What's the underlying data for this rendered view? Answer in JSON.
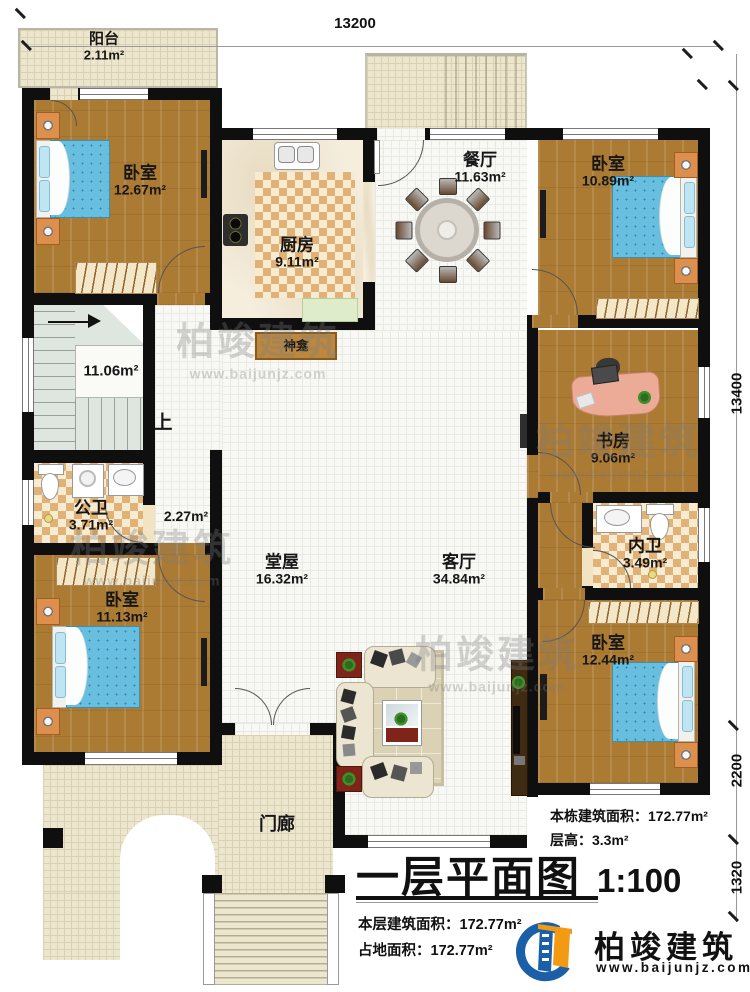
{
  "plan": {
    "title": "一层平面图",
    "scale": "1:100"
  },
  "dimensions": {
    "top": "13200",
    "right_upper": "13400",
    "right_middle": "2200",
    "right_lower": "1320"
  },
  "rooms": {
    "balcony": {
      "name": "阳台",
      "area": "2.11m²"
    },
    "bedroom_nw": {
      "name": "卧室",
      "area": "12.67m²"
    },
    "kitchen": {
      "name": "厨房",
      "area": "9.11m²"
    },
    "dining": {
      "name": "餐厅",
      "area": "11.63m²"
    },
    "bedroom_ne": {
      "name": "卧室",
      "area": "10.89m²"
    },
    "stairwell": {
      "area": "11.06m²",
      "up": "上"
    },
    "shrine": {
      "name": "神龛"
    },
    "public_bath": {
      "name": "公卫",
      "area": "3.71m²"
    },
    "corridor": {
      "area": "2.27m²"
    },
    "hall": {
      "name": "堂屋",
      "area": "16.32m²"
    },
    "study": {
      "name": "书房",
      "area": "9.06m²"
    },
    "inner_bath": {
      "name": "内卫",
      "area": "3.49m²"
    },
    "bedroom_sw": {
      "name": "卧室",
      "area": "11.13m²"
    },
    "living": {
      "name": "客厅",
      "area": "34.84m²"
    },
    "bedroom_se": {
      "name": "卧室",
      "area": "12.44m²"
    },
    "porch": {
      "name": "门廊"
    }
  },
  "stats": {
    "building_total": "本栋建筑面积：172.77m²",
    "floor_height": "层高：3.3m²",
    "floor_area": "本层建筑面积：172.77m²",
    "land_area": "占地面积：172.77m²"
  },
  "branding": {
    "company": "柏竣建筑",
    "website": "www.baijunjz.com"
  },
  "watermark": {
    "line1": "柏竣建筑",
    "line2": "www.baijunjz.com"
  },
  "colors": {
    "wall": "#0f0f0f",
    "wood_floor": "#ab7a33",
    "checker_tile": "#e0b277",
    "bed_blue": "#66bede",
    "logo_blue": "#1a5fa8",
    "logo_orange": "#f29b12"
  }
}
